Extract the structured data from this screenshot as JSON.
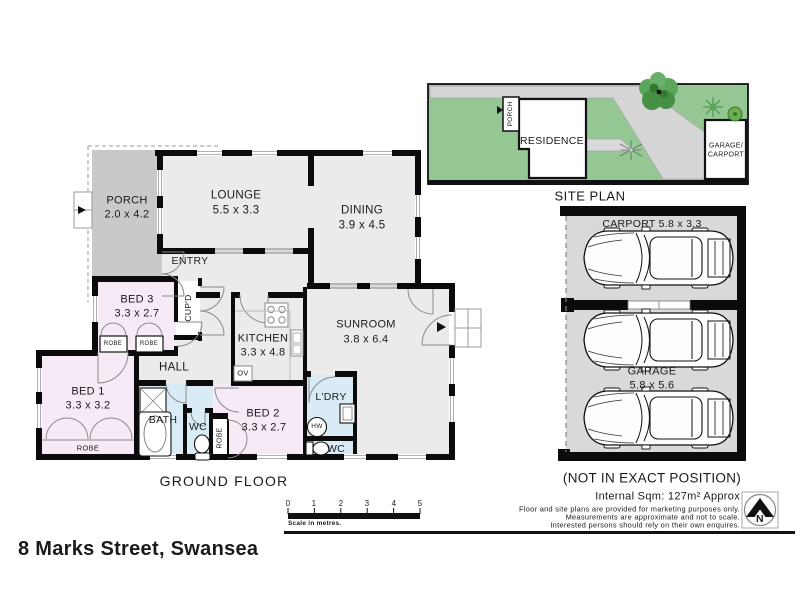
{
  "address": "8 Marks Street, Swansea",
  "ground_floor": {
    "caption": "GROUND FLOOR",
    "rooms": {
      "porch": {
        "name": "PORCH",
        "dims": "2.0 x 4.2"
      },
      "lounge": {
        "name": "LOUNGE",
        "dims": "5.5 x 3.3"
      },
      "dining": {
        "name": "DINING",
        "dims": "3.9 x 4.5"
      },
      "bed1": {
        "name": "BED 1",
        "dims": "3.3 x 3.2"
      },
      "bed2": {
        "name": "BED 2",
        "dims": "3.3 x 2.7"
      },
      "bed3": {
        "name": "BED 3",
        "dims": "3.3 x 2.7"
      },
      "kitchen": {
        "name": "KITCHEN",
        "dims": "3.3 x 4.8"
      },
      "sunroom": {
        "name": "SUNROOM",
        "dims": "3.8 x 6.4"
      }
    },
    "labels": {
      "entry": "ENTRY",
      "hall": "HALL",
      "bath": "BATH",
      "wc": "WC",
      "ldry": "L'DRY",
      "robe": "ROBE",
      "cupd": "CUP'D",
      "ov": "OV",
      "hw": "HW"
    }
  },
  "site_plan": {
    "caption": "SITE PLAN",
    "residence": "RESIDENCE",
    "porch": "PORCH",
    "garage_line1": "GARAGE/",
    "garage_line2": "CARPORT"
  },
  "parking": {
    "carport": "CARPORT 5.8 x 3.3",
    "garage": "GARAGE",
    "garage_dims": "5.8 x 5.6",
    "note": "(NOT IN EXACT POSITION)"
  },
  "footer": {
    "internal_area": "Internal Sqm: 127m² Approx",
    "disclaimer_1": "Floor and site plans are provided for marketing purposes only.",
    "disclaimer_2": "Measurements are approximate and not to scale.",
    "disclaimer_3": "Interested persons should rely on their own enquires.",
    "north": "N"
  },
  "scale_bar": {
    "ticks": [
      "0",
      "1",
      "2",
      "3",
      "4",
      "5"
    ],
    "caption": "Scale in metres."
  },
  "colors": {
    "room_fill": "#ebebeb",
    "bedroom_fill": "#f7eaf7",
    "wet_area_fill": "#d9ecf5",
    "porch_fill": "#c9c9c9",
    "wall": "#0b0b0b",
    "site_green": "#94c794",
    "driveway_grey": "#d5d5d5",
    "garage_floor": "#d9d9d9"
  }
}
